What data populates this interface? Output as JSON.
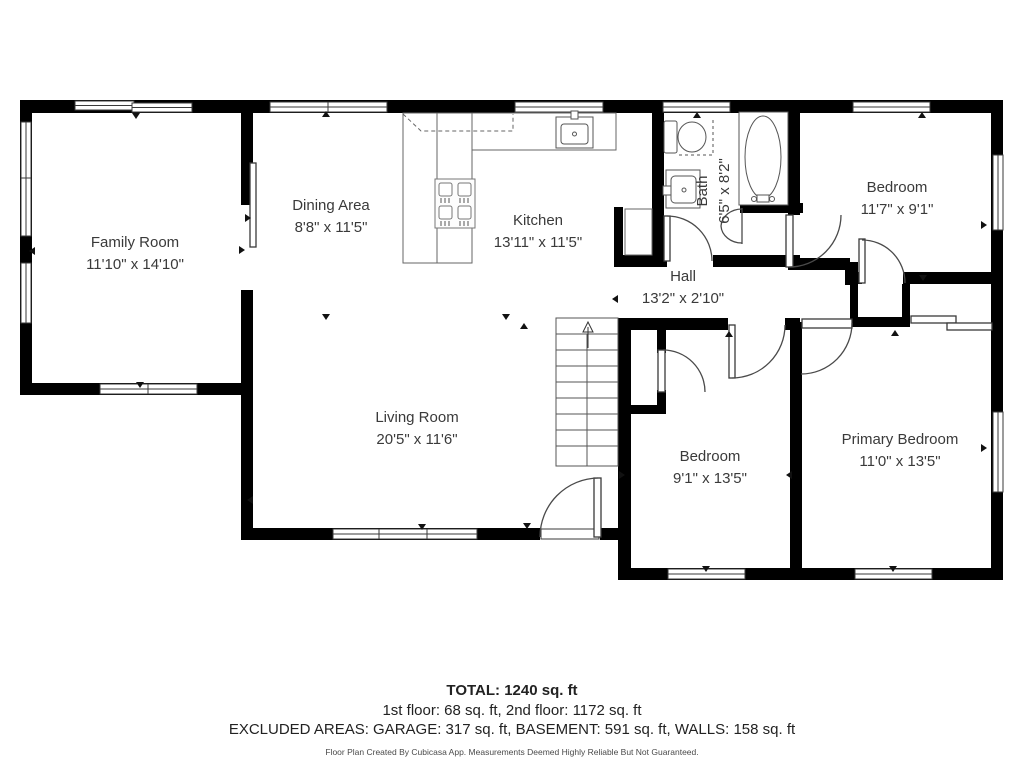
{
  "rooms": [
    {
      "name": "Family Room",
      "dims": "11'10\" x 14'10\""
    },
    {
      "name": "Dining Area",
      "dims": "8'8\" x 11'5\""
    },
    {
      "name": "Kitchen",
      "dims": "13'11\" x 11'5\""
    },
    {
      "name": "Bath",
      "dims": "6'5\" x 8'2\""
    },
    {
      "name": "Bedroom",
      "dims": "11'7\" x 9'1\""
    },
    {
      "name": "Hall",
      "dims": "13'2\" x 2'10\""
    },
    {
      "name": "Living Room",
      "dims": "20'5\" x 11'6\""
    },
    {
      "name": "Bedroom",
      "dims": "9'1\" x 13'5\""
    },
    {
      "name": "Primary Bedroom",
      "dims": "11'0\" x 13'5\""
    }
  ],
  "summary": {
    "total": "TOTAL: 1240 sq. ft",
    "floors": "1st floor: 68 sq. ft, 2nd floor: 1172 sq. ft",
    "excluded": "EXCLUDED AREAS: GARAGE: 317 sq. ft, BASEMENT: 591 sq. ft, WALLS: 158 sq. ft",
    "disclaimer": "Floor Plan Created By Cubicasa App. Measurements Deemed Highly Reliable But Not Guaranteed."
  },
  "colors": {
    "wall": "#000000",
    "background": "#ffffff",
    "text": "#3a3a3a",
    "fixture_line": "#555555"
  }
}
